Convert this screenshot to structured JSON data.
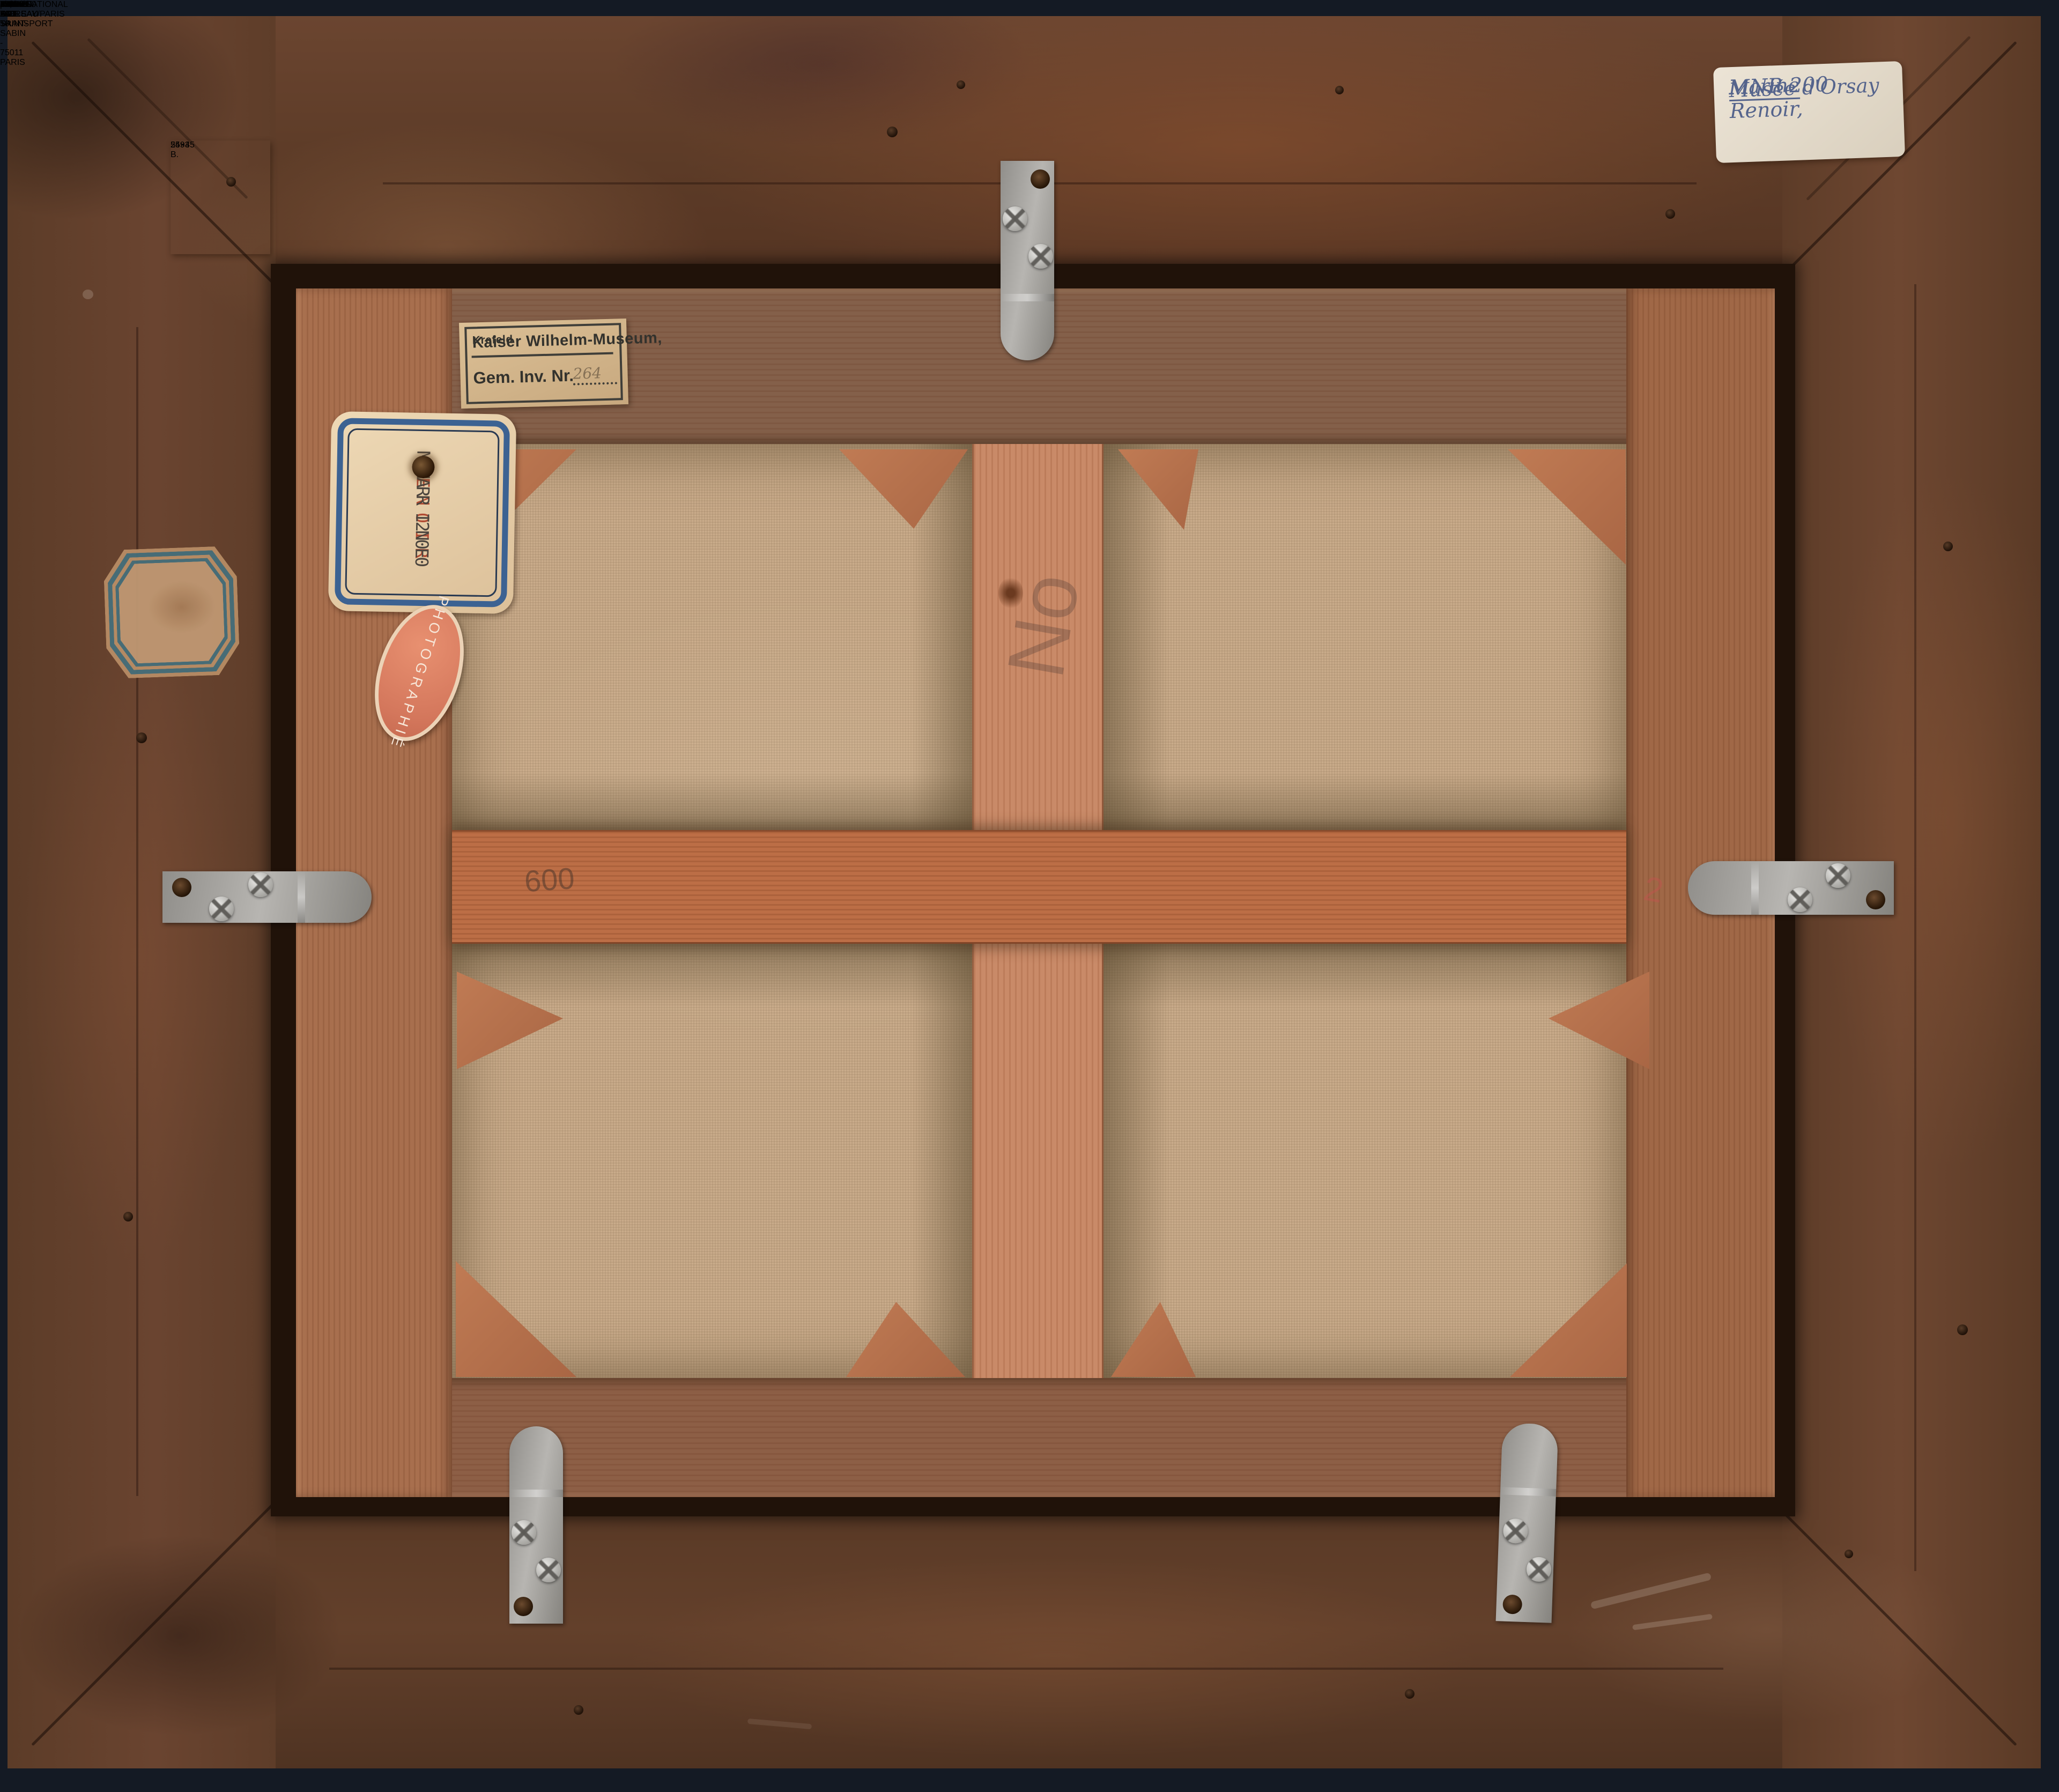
{
  "labels": {
    "kaiser_museum": {
      "name": "Kaiser Wilhelm-Museum,",
      "city": "Krefeld",
      "field": "Gem. Inv. Nr.",
      "value": "264"
    },
    "mnr_card": {
      "line1": "MNR 200",
      "line2": "RENOIR",
      "line3": "MARINE"
    },
    "photographie_stamp": {
      "text": "PHOTOGRAPHIÉ"
    },
    "handwritten_inventory": {
      "line1": "MNR 200 Renoir,",
      "line2": "Marine",
      "line3": "Musée d'Orsay"
    },
    "frame_number": {
      "number": "2593 B.",
      "size": "54×45"
    },
    "fragment_label": {
      "line1_prefix": "MNR ",
      "line1_number": "200",
      "line2": "Renoir",
      "line3": "Marine",
      "line4": "236",
      "line5": "C."
    },
    "stretcher_note": {
      "number": "3325",
      "size": "45×53",
      "note": "photo"
    },
    "canvas_stencil": {
      "text": "MNR 200"
    },
    "orsay_label": {
      "museum": "MUSEE D'ORSAY",
      "inventory": "MNR 200",
      "artist": "RENOIR",
      "title": "Marine"
    },
    "transport_label": {
      "company": "INTERNATIONAL ART TRANSPORT",
      "address": "60, RUE SAINT-SABIN - 75011 PARIS",
      "phone": "806-50-50",
      "artist_field": "Artiste",
      "ref_field": "N/Réf.",
      "ref_value": "IO398 DD",
      "title_field": "Titre",
      "title_value": "I TABLEAU",
      "lender_field": "Prêteur",
      "lender_value": "MUSEE D'ORSAY/PARIS"
    }
  },
  "annotations": {
    "scribble_no": "No",
    "scribble_600": "600",
    "scribble_red": "2"
  },
  "colors": {
    "frame_wood": "#5f3e2a",
    "stretcher_wood": "#a86f4e",
    "crossbar_vertical": "#c98a68",
    "crossbar_horizontal": "#bc6e46",
    "canvas": "#c9ab8a",
    "label_blue": "#3a4f9c",
    "transport_blue": "#42418f",
    "teal_border": "#3f7280",
    "stamp_red": "#d4775c",
    "ink_blue": "#55648c",
    "metal_gray": "#a5a3a0",
    "stencil_black": "#2a2824"
  }
}
